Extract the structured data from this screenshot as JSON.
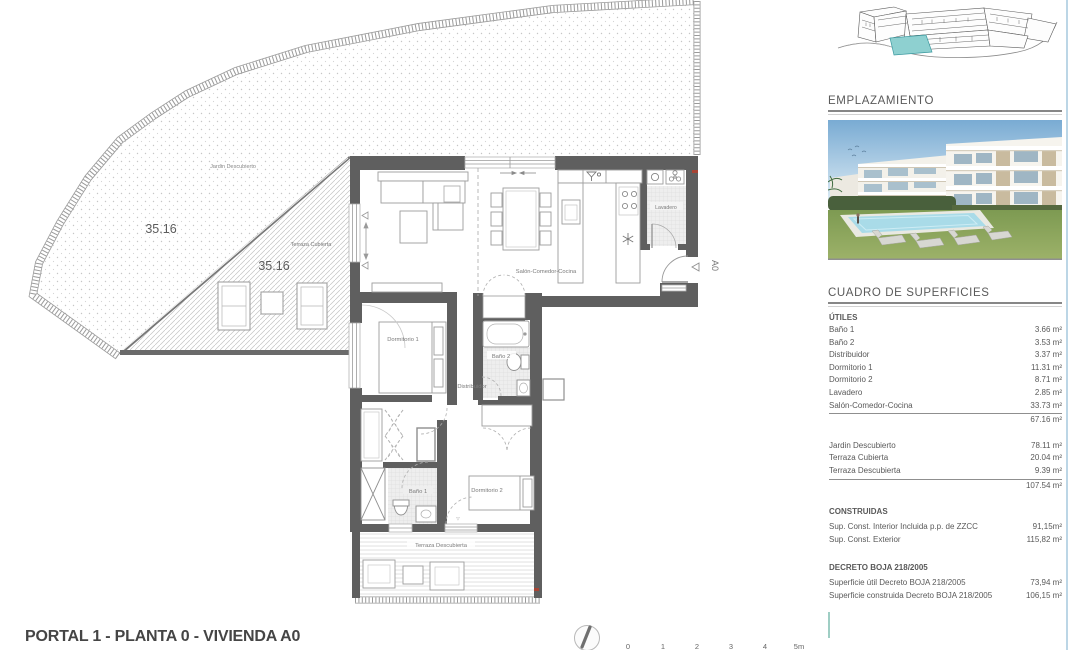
{
  "page": {
    "title": "PORTAL 1 - PLANTA 0 - VIVIENDA A0"
  },
  "plan": {
    "labels": {
      "jardin": "Jardin Descubierto",
      "jardin_area": "35.16",
      "terraza_cubierta": "Terraza Cubierta",
      "terraza_cubierta_area": "35.16",
      "salon": "Salón-Comedor-Cocina",
      "dormitorio1": "Dormitorio 1",
      "dormitorio2": "Dormitorio 2",
      "bano1": "Baño 1",
      "bano2": "Baño 2",
      "distribuidor": "Distribuidor",
      "lavadero": "Lavadero",
      "terraza_descubierta": "Terraza Descubierta",
      "entrance_tag": "A0"
    },
    "scale_ticks": [
      "0",
      "1",
      "2",
      "3",
      "4",
      "5m"
    ],
    "icons": {
      "north": "north-arrow",
      "sink": "kitchen-sink-icon",
      "hob": "hob-burners-icon",
      "fridge": "snowflake-icon",
      "washer": "washing-machine-icon",
      "extractor": "extractor-fan-icon"
    },
    "highlight_color": "#8ed0d0"
  },
  "sidebar": {
    "emplazamiento_heading": "EMPLAZAMIENTO",
    "superficies": {
      "heading": "CUADRO DE SUPERFICIES",
      "utiles": {
        "heading": "ÚTILES",
        "rows": [
          {
            "label": "Baño 1",
            "value": "3.66 m²"
          },
          {
            "label": "Baño 2",
            "value": "3.53 m²"
          },
          {
            "label": "Distribuidor",
            "value": "3.37 m²"
          },
          {
            "label": "Dormitorio 1",
            "value": "11.31 m²"
          },
          {
            "label": "Dormitorio 2",
            "value": "8.71 m²"
          },
          {
            "label": "Lavadero",
            "value": "2.85 m²"
          },
          {
            "label": "Salón-Comedor-Cocina",
            "value": "33.73 m²"
          }
        ],
        "subtotal": "67.16 m²"
      },
      "exterior": {
        "rows": [
          {
            "label": "Jardin Descubierto",
            "value": "78.11 m²"
          },
          {
            "label": "Terraza Cubierta",
            "value": "20.04 m²"
          },
          {
            "label": "Terraza Descubierta",
            "value": "9.39 m²"
          }
        ],
        "subtotal": "107.54 m²"
      },
      "construidas": {
        "heading": "CONSTRUIDAS",
        "rows": [
          {
            "label": "Sup. Const. Interior Incluida p.p. de ZZCC",
            "value": "91,15m²"
          },
          {
            "label": "Sup. Const. Exterior",
            "value": "115,82 m²"
          }
        ]
      },
      "decreto": {
        "heading": "DECRETO BOJA 218/2005",
        "rows": [
          {
            "label": "Superficie útil Decreto BOJA 218/2005",
            "value": "73,94 m²"
          },
          {
            "label": "Superficie construida Decreto BOJA 218/2005",
            "value": "106,15 m²"
          }
        ]
      }
    }
  }
}
